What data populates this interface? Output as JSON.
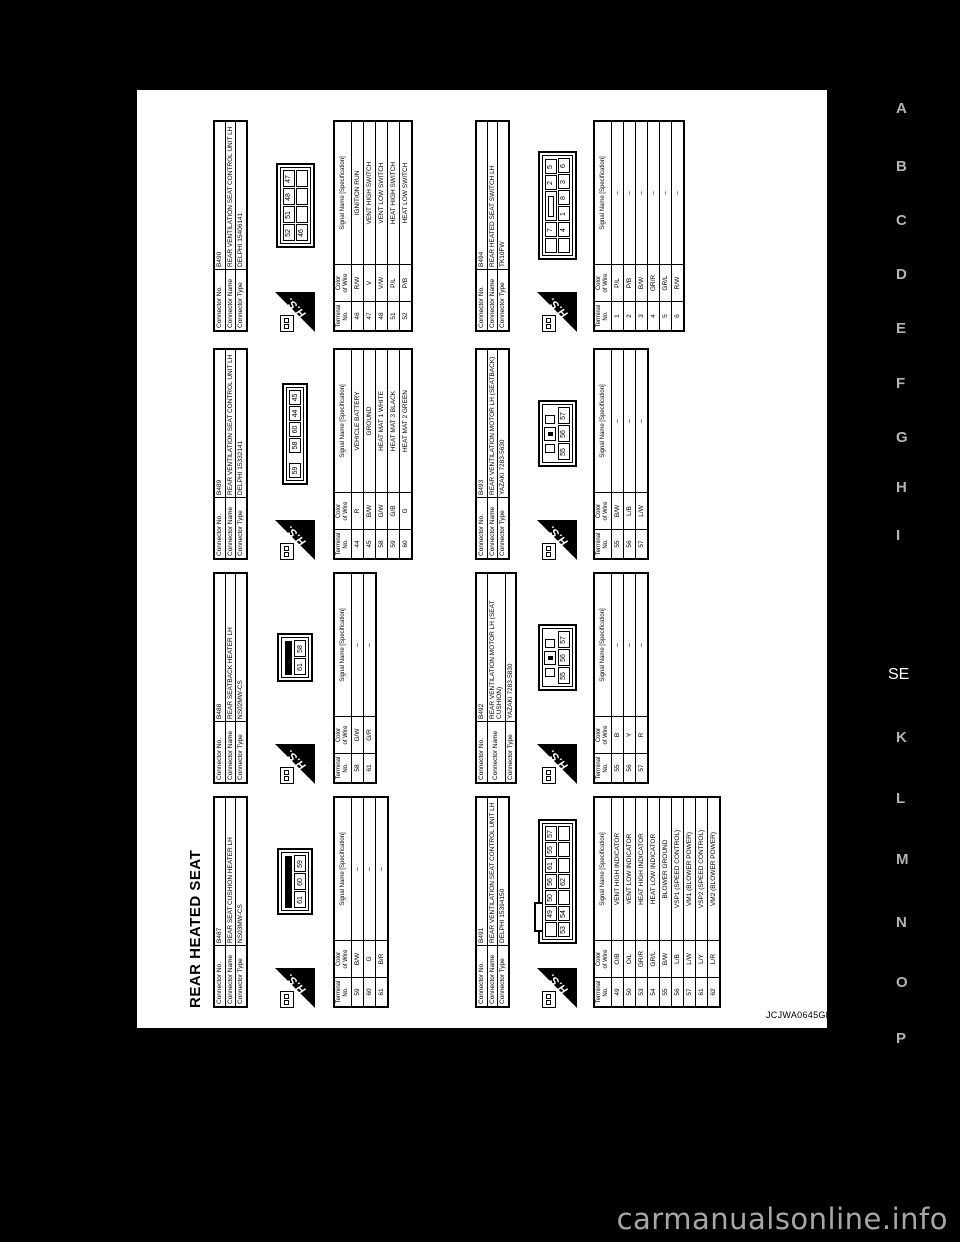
{
  "title": "REAR HEATED SEAT",
  "figure_code": "JCJWA0645GB",
  "watermark": "carmanualsonline.info",
  "margin": {
    "letters": [
      {
        "label": "A",
        "active": false
      },
      {
        "label": "B",
        "active": false
      },
      {
        "label": "C",
        "active": false
      },
      {
        "label": "D",
        "active": false
      },
      {
        "label": "E",
        "active": false
      },
      {
        "label": "F",
        "active": false
      },
      {
        "label": "G",
        "active": false
      },
      {
        "label": "H",
        "active": false
      },
      {
        "label": "I",
        "active": false
      },
      {
        "label": "SE",
        "active": true
      },
      {
        "label": "K",
        "active": false
      },
      {
        "label": "L",
        "active": false
      },
      {
        "label": "M",
        "active": false
      },
      {
        "label": "N",
        "active": false
      },
      {
        "label": "O",
        "active": false
      },
      {
        "label": "P",
        "active": false
      }
    ]
  },
  "labels": {
    "connector_no": "Connector No.",
    "connector_name": "Connector Name",
    "connector_type": "Connector Type",
    "terminal_no": "Terminal\nNo.",
    "color_of_wire": "Color\nof Wire",
    "signal_name": "Signal Name [Specification]",
    "hs": "H.S."
  },
  "connectors": [
    {
      "no": "B487",
      "name": "REAR SEAT CUSHION HEATER LH",
      "type": "NS03MW-CS",
      "grid": {
        "row": "A",
        "col": 1
      },
      "pin_diagram": {
        "style": "heater",
        "rows": [
          [
            "61",
            "60",
            "59"
          ]
        ]
      },
      "terminals": [
        {
          "no": "59",
          "color": "B/W",
          "signal": "–"
        },
        {
          "no": "60",
          "color": "G",
          "signal": "–"
        },
        {
          "no": "61",
          "color": "B/R",
          "signal": "–"
        }
      ]
    },
    {
      "no": "B488",
      "name": "REAR SEATBACK HEATER LH",
      "type": "NS02MW-CS",
      "grid": {
        "row": "A",
        "col": 2
      },
      "pin_diagram": {
        "style": "heater",
        "rows": [
          [
            "61",
            "58"
          ]
        ]
      },
      "terminals": [
        {
          "no": "58",
          "color": "G/W",
          "signal": "–"
        },
        {
          "no": "61",
          "color": "G/R",
          "signal": "–"
        }
      ]
    },
    {
      "no": "B489",
      "name": "REAR VENTILATION SEAT CONTROL UNIT LH",
      "type": "DELPHI 15332141",
      "grid": {
        "row": "A",
        "col": 3
      },
      "pin_diagram": {
        "style": "inline",
        "rows": [
          [
            "59",
            "",
            "58",
            "60",
            "44",
            "45"
          ]
        ]
      },
      "terminals": [
        {
          "no": "44",
          "color": "R",
          "signal": "VEHICLE BATTERY"
        },
        {
          "no": "45",
          "color": "B/W",
          "signal": "GROUND"
        },
        {
          "no": "58",
          "color": "G/W",
          "signal": "HEAT MAT 1 WHITE"
        },
        {
          "no": "59",
          "color": "G/B",
          "signal": "HEAT MAT 3 BLACK"
        },
        {
          "no": "60",
          "color": "G",
          "signal": "HEAT MAT 2 GREEN"
        }
      ]
    },
    {
      "no": "B490",
      "name": "REAR VENTILATION SEAT CONTROL UNIT LH",
      "type": "DELPHI 15406141",
      "grid": {
        "row": "A",
        "col": 4
      },
      "pin_diagram": {
        "style": "grid",
        "rows": [
          [
            "52",
            "51",
            "48",
            "47"
          ],
          [
            "46",
            "",
            "",
            ""
          ]
        ]
      },
      "terminals": [
        {
          "no": "46",
          "color": "R/W",
          "signal": "IGNITION RUN"
        },
        {
          "no": "47",
          "color": "V",
          "signal": "VENT HIGH SWITCH"
        },
        {
          "no": "48",
          "color": "V/W",
          "signal": "VENT LOW SWITCH"
        },
        {
          "no": "51",
          "color": "P/L",
          "signal": "HEAT HIGH SWITCH"
        },
        {
          "no": "52",
          "color": "P/B",
          "signal": "HEAT LOW SWITCH"
        }
      ]
    },
    {
      "no": "B491",
      "name": "REAR VENTILATION SEAT CONTROL UNIT LH",
      "type": "DELPHI 15394150",
      "grid": {
        "row": "B",
        "col": 1
      },
      "pin_diagram": {
        "style": "grid",
        "tab": true,
        "rows": [
          [
            "",
            "49",
            "50",
            "56",
            "61",
            "55",
            "57"
          ],
          [
            "53",
            "54",
            "",
            "62",
            "",
            "",
            ""
          ]
        ]
      },
      "terminals": [
        {
          "no": "49",
          "color": "O/B",
          "signal": "VENT HIGH INDICATOR"
        },
        {
          "no": "50",
          "color": "O/L",
          "signal": "VENT LOW INDICATOR"
        },
        {
          "no": "53",
          "color": "GR/R",
          "signal": "HEAT HIGH INDICATOR"
        },
        {
          "no": "54",
          "color": "GR/L",
          "signal": "HEAT LOW INDICATOR"
        },
        {
          "no": "55",
          "color": "B/W",
          "signal": "BLOWER GROUND"
        },
        {
          "no": "56",
          "color": "L/B",
          "signal": "VSP1 (SPEED CONTROL)"
        },
        {
          "no": "57",
          "color": "L/W",
          "signal": "VM1 (BLOWER POWER)"
        },
        {
          "no": "61",
          "color": "L/Y",
          "signal": "VSP2 (SPEED CONTROL)"
        },
        {
          "no": "62",
          "color": "L/R",
          "signal": "VM2 (BLOWER POWER)"
        }
      ]
    },
    {
      "no": "B492",
      "name": "REAR VENTILATION MOTOR LH (SEAT CUSHION)",
      "type": "YAZAKI 7283-5830",
      "grid": {
        "row": "B",
        "col": 2
      },
      "pin_diagram": {
        "style": "motor",
        "rows": [
          [
            "55",
            "56",
            "57"
          ]
        ]
      },
      "terminals": [
        {
          "no": "55",
          "color": "B",
          "signal": "–"
        },
        {
          "no": "56",
          "color": "Y",
          "signal": "–"
        },
        {
          "no": "57",
          "color": "R",
          "signal": "–"
        }
      ]
    },
    {
      "no": "B493",
      "name": "REAR VENTILATION MOTOR LH (SEATBACK)",
      "type": "YAZAKI 7283-5630",
      "grid": {
        "row": "B",
        "col": 3
      },
      "pin_diagram": {
        "style": "motor",
        "rows": [
          [
            "55",
            "56",
            "57"
          ]
        ]
      },
      "terminals": [
        {
          "no": "55",
          "color": "B/W",
          "signal": "–"
        },
        {
          "no": "56",
          "color": "L/B",
          "signal": "–"
        },
        {
          "no": "57",
          "color": "L/W",
          "signal": "–"
        }
      ]
    },
    {
      "no": "B494",
      "name": "REAR HEATED SEAT SWITCH LH",
      "type": "TK10FW",
      "grid": {
        "row": "B",
        "col": 4
      },
      "pin_diagram": {
        "style": "grid",
        "rows": [
          [
            "",
            "7",
            "#",
            "2",
            "5"
          ],
          [
            "",
            "4",
            "1",
            "8",
            "3",
            "6"
          ]
        ]
      },
      "terminals": [
        {
          "no": "1",
          "color": "P/L",
          "signal": "–"
        },
        {
          "no": "2",
          "color": "P/B",
          "signal": "–"
        },
        {
          "no": "3",
          "color": "B/W",
          "signal": "–"
        },
        {
          "no": "4",
          "color": "GR/R",
          "signal": "–"
        },
        {
          "no": "5",
          "color": "GR/L",
          "signal": "–"
        },
        {
          "no": "6",
          "color": "R/W",
          "signal": "–"
        }
      ]
    }
  ]
}
